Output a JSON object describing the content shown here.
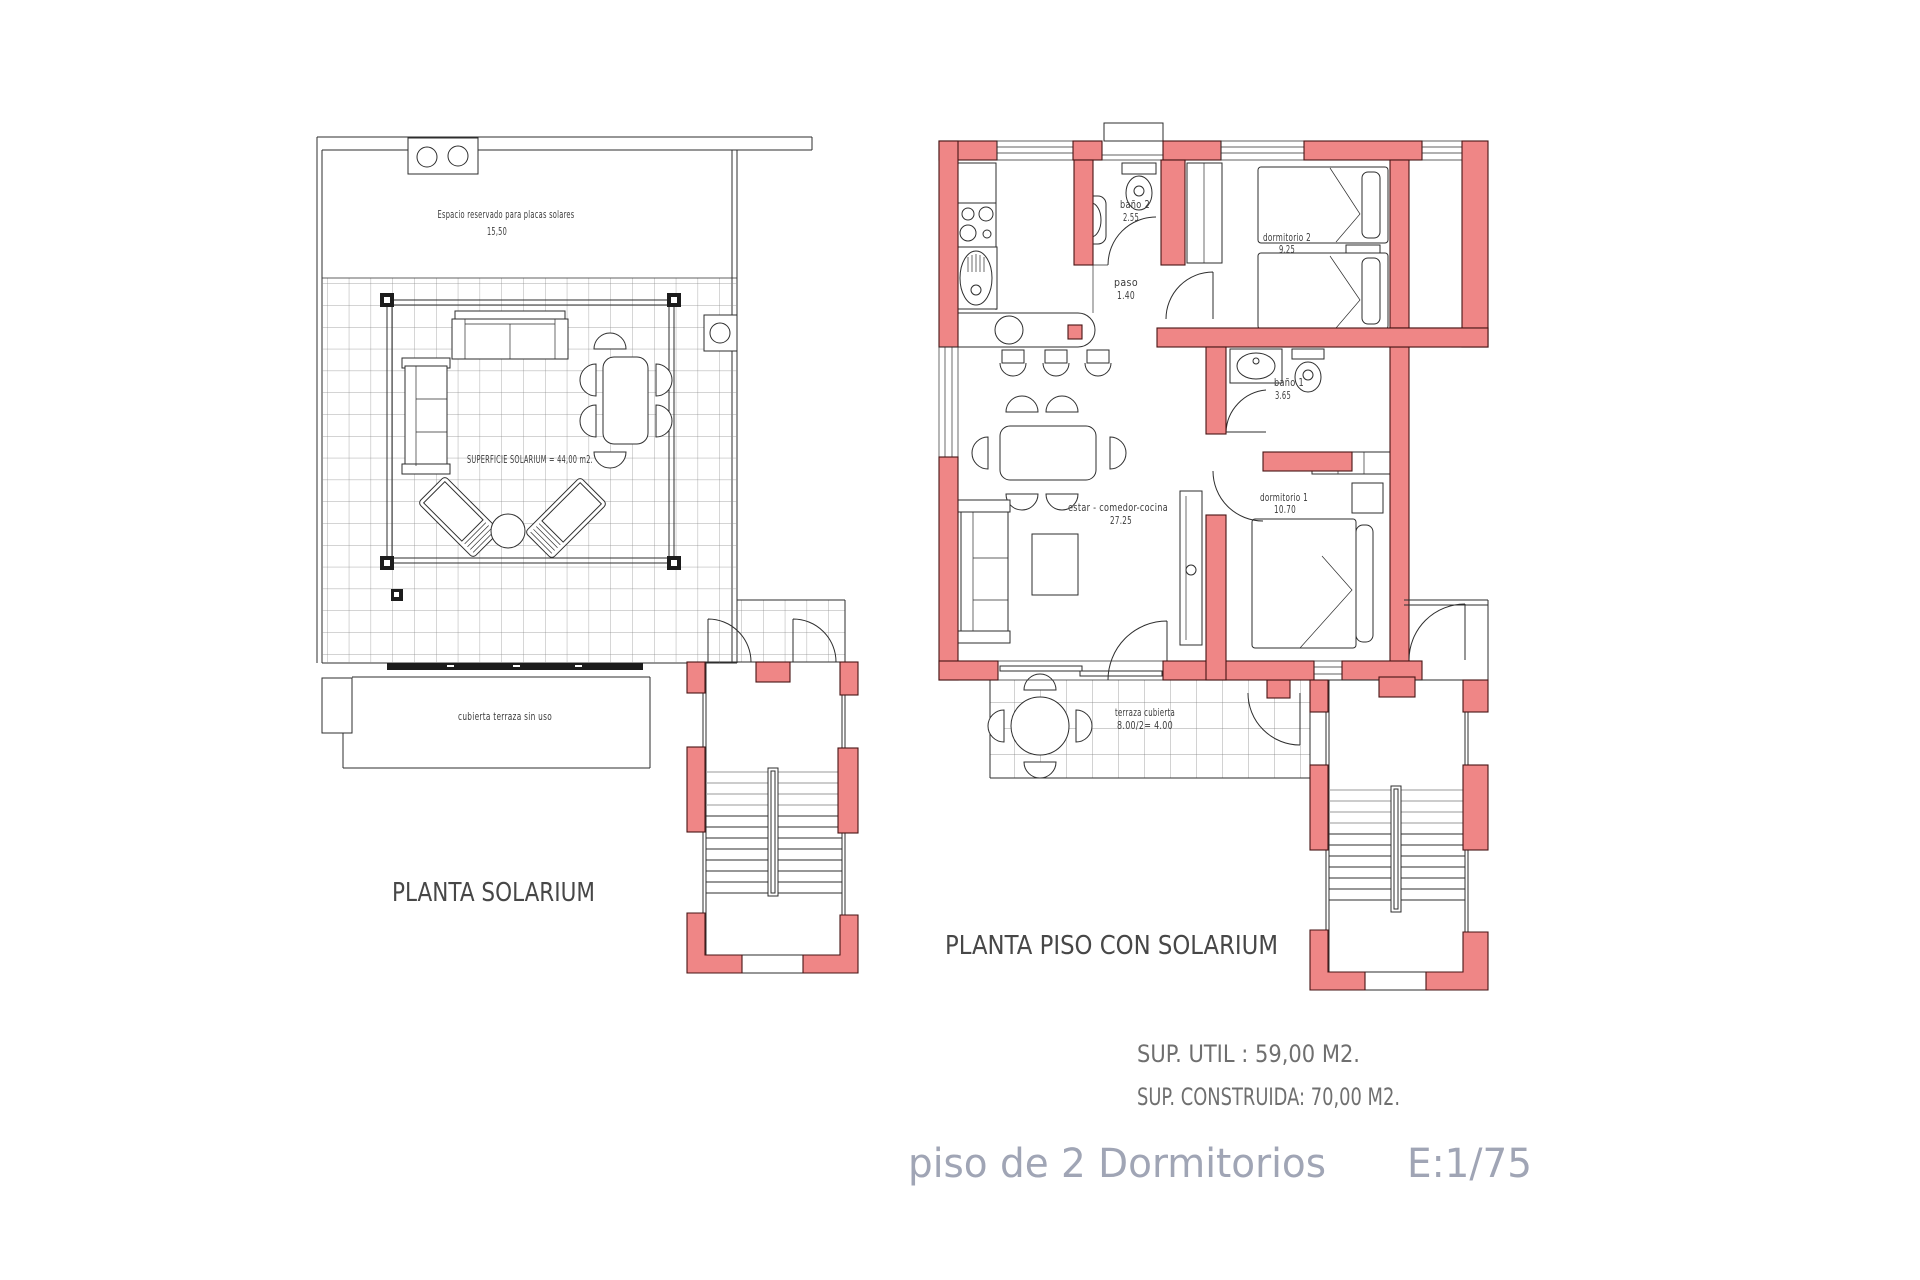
{
  "colors": {
    "wall_fill": "#EF8686",
    "wall_stroke": "#471414",
    "line": "#2E2E2E",
    "grid_line": "#8A8A8A",
    "label_text": "#3C3C3C",
    "plan_title_text": "#474747",
    "summary_text": "#6F6F6F",
    "caption_text": "#A0A5B5"
  },
  "solarium_plan": {
    "title": "PLANTA SOLARIUM",
    "labels": {
      "reserved": "Espacio reservado para placas solares",
      "reserved_area": "15,50",
      "surface": "SUPERFICIE SOLARIUM = 44,00 m2.",
      "terrace": "cubierta terraza sin uso"
    }
  },
  "floor_plan": {
    "title": "PLANTA PISO CON SOLARIUM",
    "rooms": {
      "bano2": {
        "name": "baño 2",
        "area": "2.55"
      },
      "paso": {
        "name": "paso",
        "area": "1.40"
      },
      "dorm2": {
        "name": "dormitorio 2",
        "area": "9.25"
      },
      "bano1": {
        "name": "baño 1",
        "area": "3.65"
      },
      "estar": {
        "name": "estar - comedor-cocina",
        "area": "27.25"
      },
      "dorm1": {
        "name": "dormitorio 1",
        "area": "10.70"
      },
      "terraza": {
        "name": "terraza cubierta",
        "area": "8.00/2= 4.00"
      }
    }
  },
  "summary": {
    "util": "SUP. UTIL : 59,00 M2.",
    "construida": "SUP. CONSTRUIDA: 70,00 M2.",
    "caption": "piso de 2 Dormitorios",
    "scale": "E:1/75"
  }
}
